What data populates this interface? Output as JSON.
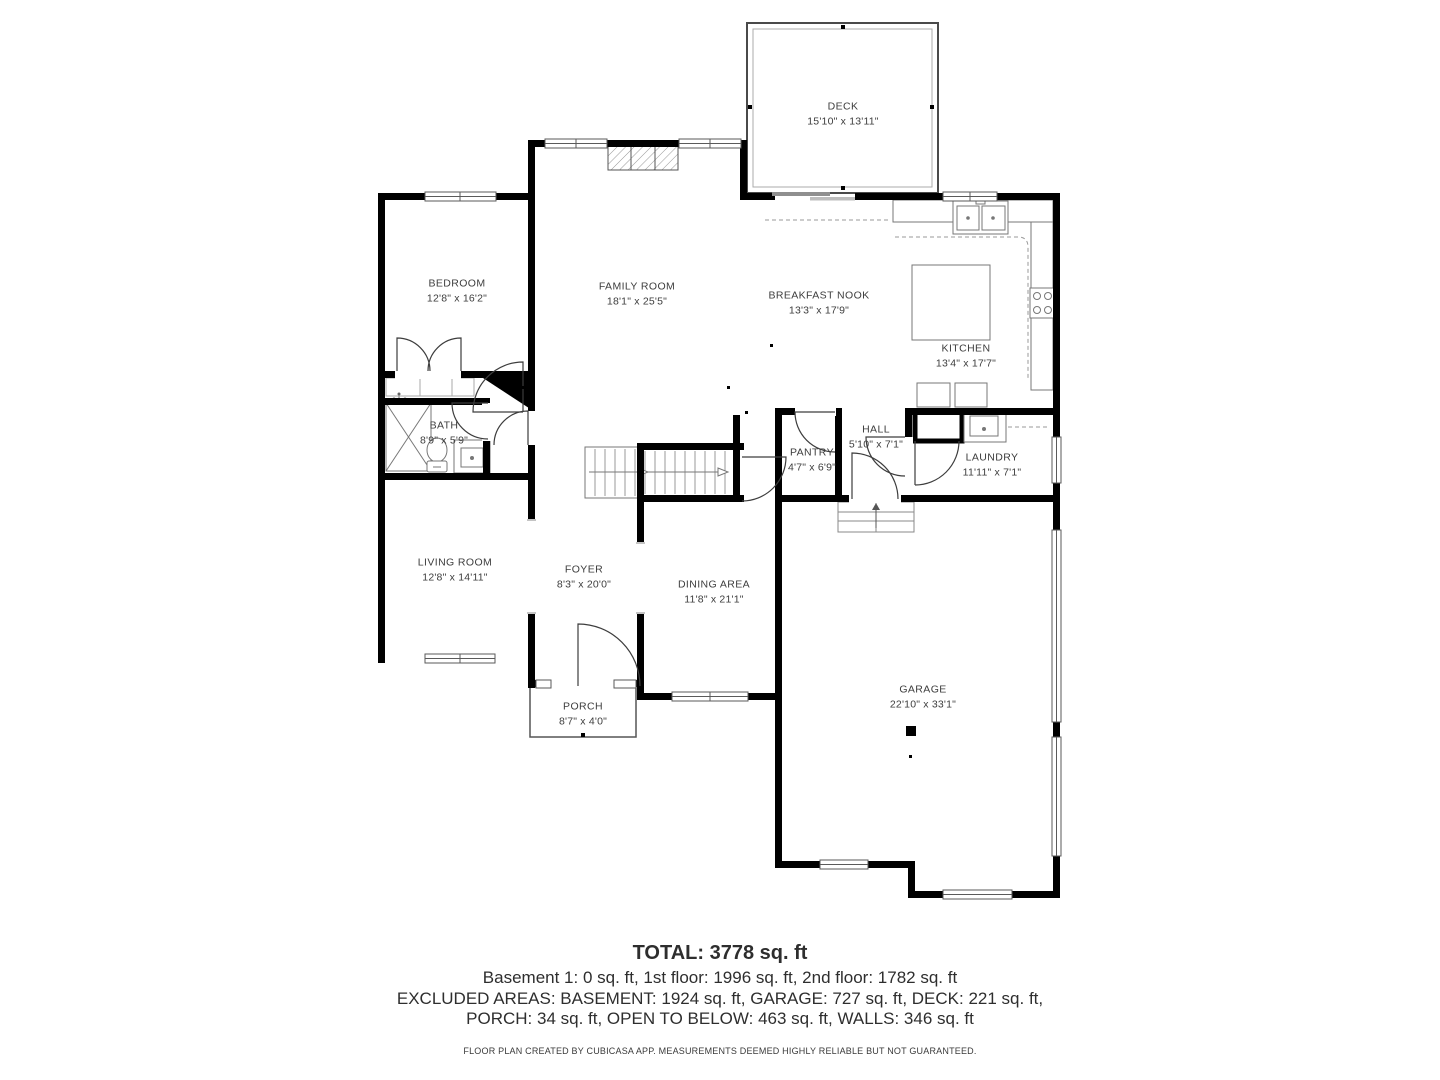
{
  "plan": {
    "rooms": [
      {
        "id": "deck",
        "name": "DECK",
        "dims": "15'10\" x 13'11\""
      },
      {
        "id": "bedroom",
        "name": "BEDROOM",
        "dims": "12'8\" x 16'2\""
      },
      {
        "id": "family-room",
        "name": "FAMILY ROOM",
        "dims": "18'1\" x 25'5\""
      },
      {
        "id": "breakfast-nook",
        "name": "BREAKFAST NOOK",
        "dims": "13'3\" x 17'9\""
      },
      {
        "id": "kitchen",
        "name": "KITCHEN",
        "dims": "13'4\" x 17'7\""
      },
      {
        "id": "bath",
        "name": "BATH",
        "dims": "8'9\" x 5'9\""
      },
      {
        "id": "pantry",
        "name": "PANTRY",
        "dims": "4'7\" x 6'9\""
      },
      {
        "id": "hall",
        "name": "HALL",
        "dims": "5'10\" x 7'1\""
      },
      {
        "id": "laundry",
        "name": "LAUNDRY",
        "dims": "11'11\" x 7'1\""
      },
      {
        "id": "living-room",
        "name": "LIVING ROOM",
        "dims": "12'8\" x 14'11\""
      },
      {
        "id": "foyer",
        "name": "FOYER",
        "dims": "8'3\" x 20'0\""
      },
      {
        "id": "dining-area",
        "name": "DINING AREA",
        "dims": "11'8\" x 21'1\""
      },
      {
        "id": "porch",
        "name": "PORCH",
        "dims": "8'7\" x 4'0\""
      },
      {
        "id": "garage",
        "name": "GARAGE",
        "dims": "22'10\" x 33'1\""
      }
    ]
  },
  "summary": {
    "total": "TOTAL: 3778 sq. ft",
    "lines": [
      "Basement 1: 0 sq. ft, 1st floor: 1996 sq. ft, 2nd floor: 1782 sq. ft",
      "EXCLUDED AREAS: BASEMENT: 1924 sq. ft, GARAGE: 727 sq. ft, DECK: 221 sq. ft,",
      "PORCH: 34 sq. ft, OPEN TO BELOW: 463 sq. ft, WALLS: 346 sq. ft"
    ],
    "disclaimer": "FLOOR PLAN CREATED BY CUBICASA APP. MEASUREMENTS DEEMED HIGHLY RELIABLE BUT NOT GUARANTEED."
  },
  "colors": {
    "wall": "#000000",
    "text": "#3d3d3d",
    "thin_line": "#777777"
  }
}
